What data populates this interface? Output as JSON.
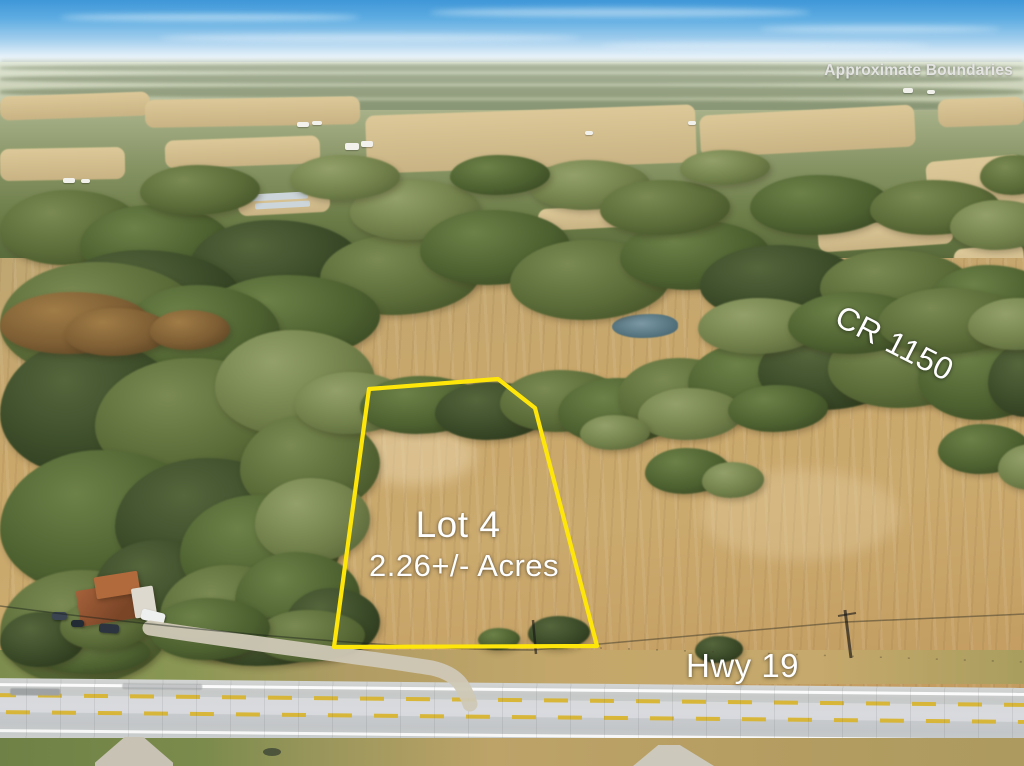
{
  "overlay": {
    "disclaimer": "Approximate Boundaries",
    "lot": {
      "name": "Lot 4",
      "acreage": "2.26+/- Acres"
    },
    "roads": {
      "highway": "Hwy 19",
      "county_road": "CR 1150"
    }
  },
  "boundary": {
    "points": "369,389 498,379 535,408 597,646 334,647"
  },
  "colors": {
    "boundary_yellow": "#FFE60A",
    "label_text": "#FFFFFF",
    "disclaimer_text": "#E3E4E2",
    "sky_top": "#3F97D8",
    "field_tan": "#C9A76B",
    "road_gray": "#C6C9C7",
    "lane_marking_yellow": "#D7B430"
  }
}
